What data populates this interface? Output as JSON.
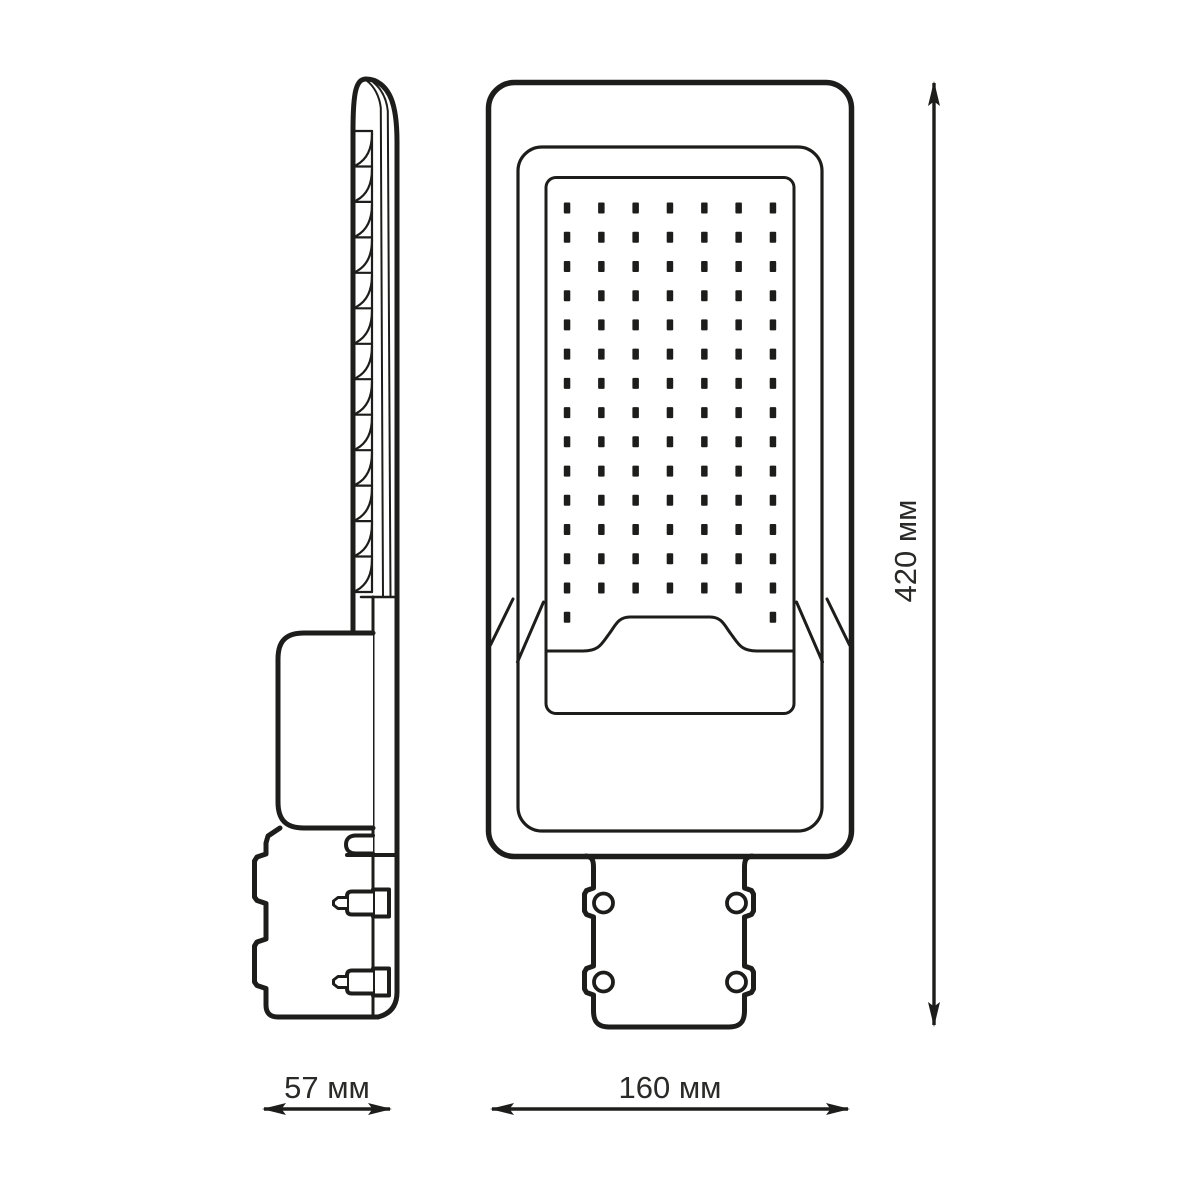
{
  "drawing": {
    "kind": "technical line drawing of LED street light, side and front views with dimensions",
    "colors": {
      "ink": "#1d1d1b",
      "background": "#ffffff"
    }
  },
  "dimensions": {
    "side_width": {
      "label": "57 мм"
    },
    "front_width": {
      "label": "160 мм"
    },
    "height": {
      "label": "420 мм"
    }
  },
  "views": {
    "side": {
      "fins": 13,
      "bracket_notches": 2,
      "mount_bolts": 3
    },
    "front": {
      "led_grid": {
        "columns": 7,
        "full_rows": 14,
        "partial_row_dots": 2,
        "total_leds": 100
      },
      "bolt_holes": 4
    }
  }
}
